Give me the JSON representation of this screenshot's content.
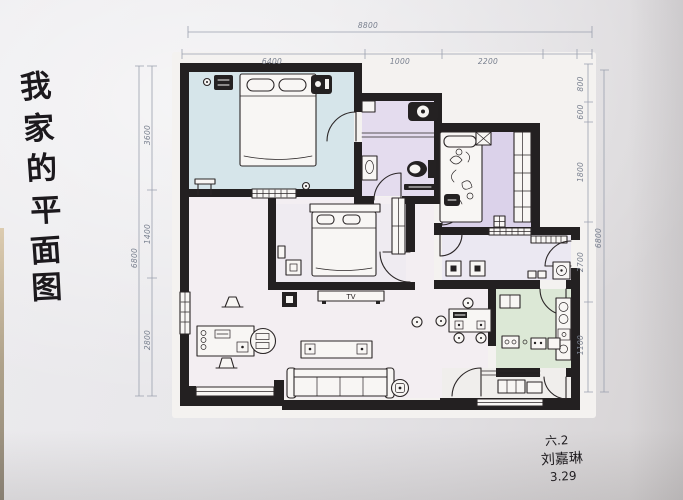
{
  "title": {
    "full": "我家的平面图",
    "chars": [
      "我",
      "家",
      "的",
      "平",
      "面",
      "图"
    ]
  },
  "signature": {
    "class_line": "六.2",
    "name": "刘嘉琳",
    "date": "3.29"
  },
  "labels": {
    "tv": "TV"
  },
  "dims": {
    "top": {
      "total": "8800",
      "s1": "6400",
      "s2": "1000",
      "s3": "2200"
    },
    "right": {
      "s1": "800",
      "s2": "600",
      "s3": "1800",
      "s4": "2700",
      "s5": "1100",
      "total": "6800"
    },
    "left": {
      "s1": "3600",
      "s2": "1400",
      "s3": "2800",
      "total": "6800"
    }
  },
  "colors": {
    "wall": "#232021",
    "ink": "#2b2627",
    "pencil": "#9aa0ae",
    "dim_text": "#79808f",
    "paper": "#f4f2f0",
    "bedroom_master": "#d6e5ea",
    "bathroom": "#e4dcee",
    "bedroom_second": "#dbd2ea",
    "bedroom_third": "#efebf1",
    "living": "#f3eef2",
    "entry_hall": "#ebe8f2",
    "kitchen": "#dce8d6",
    "balcony": "#f0eeec",
    "title_ink": "#1c191d"
  }
}
